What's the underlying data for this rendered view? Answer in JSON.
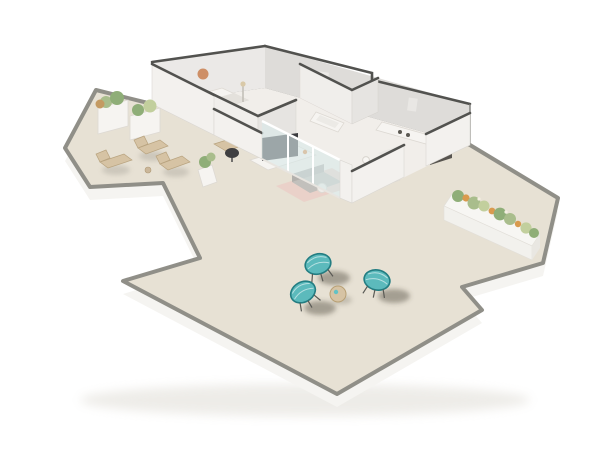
{
  "scene": {
    "type": "isometric-3d-floorplan-render",
    "description": "Cutaway 3D render of a white-walled apartment with an L-shaped wrap-around beige terrace, viewed from above on a plain white background",
    "background": "#ffffff"
  },
  "palette": {
    "background": "#ffffff",
    "slab_top": "#e7e1d4",
    "slab_rim": "#908f88",
    "slab_side": "#f5f4f1",
    "interior_floor": "#f1eeea",
    "wall_light": "#ebe9e7",
    "wall_shaded": "#dedcd9",
    "wall_front": "#f3f1ee",
    "wall_cap": "#52524f",
    "glass": "#d9e8e9",
    "rug_blush": "#eacfc8",
    "sofa_gray": "#c2c0bc",
    "screen_dark": "#3b3b3f",
    "wood_tan": "#d6c3a4",
    "plant_green": "#8fae78",
    "flower_orange": "#d99a4e",
    "chair_teal": "#49b4b8",
    "appliance_dark": "#57544f",
    "shadow": "#474238",
    "wall_art_terracotta": "#c97f4f"
  },
  "rooms": [
    {
      "id": "bedroom",
      "features": [
        "bed",
        "round-wall-art",
        "floor-lamp"
      ]
    },
    {
      "id": "home-office",
      "features": [
        "desk",
        "monitor",
        "black-office-chair",
        "potted-plant"
      ]
    },
    {
      "id": "bathroom",
      "features": [
        "bathtub"
      ]
    },
    {
      "id": "kitchen",
      "features": [
        "counter-with-cooktop",
        "dark-refrigerator",
        "washing-machine"
      ]
    },
    {
      "id": "dining-area",
      "features": [
        "dining-table",
        "four-white-chairs"
      ]
    },
    {
      "id": "living-room",
      "features": [
        "flat-tv",
        "media-console",
        "gray-sofa",
        "blush-rug",
        "coffee-table",
        "glass-sliding-doors"
      ]
    },
    {
      "id": "left-terrace",
      "features": [
        "two-planter-boxes",
        "three-wooden-loungers"
      ]
    },
    {
      "id": "main-terrace",
      "features": [
        "three-teal-acapulco-chairs",
        "round-side-table"
      ]
    },
    {
      "id": "right-terrace",
      "features": [
        "long-flower-planter"
      ]
    }
  ],
  "counts": {
    "teal_chairs": 3,
    "wooden_loungers": 3,
    "dining_chairs": 4,
    "left_planter_boxes": 2
  }
}
